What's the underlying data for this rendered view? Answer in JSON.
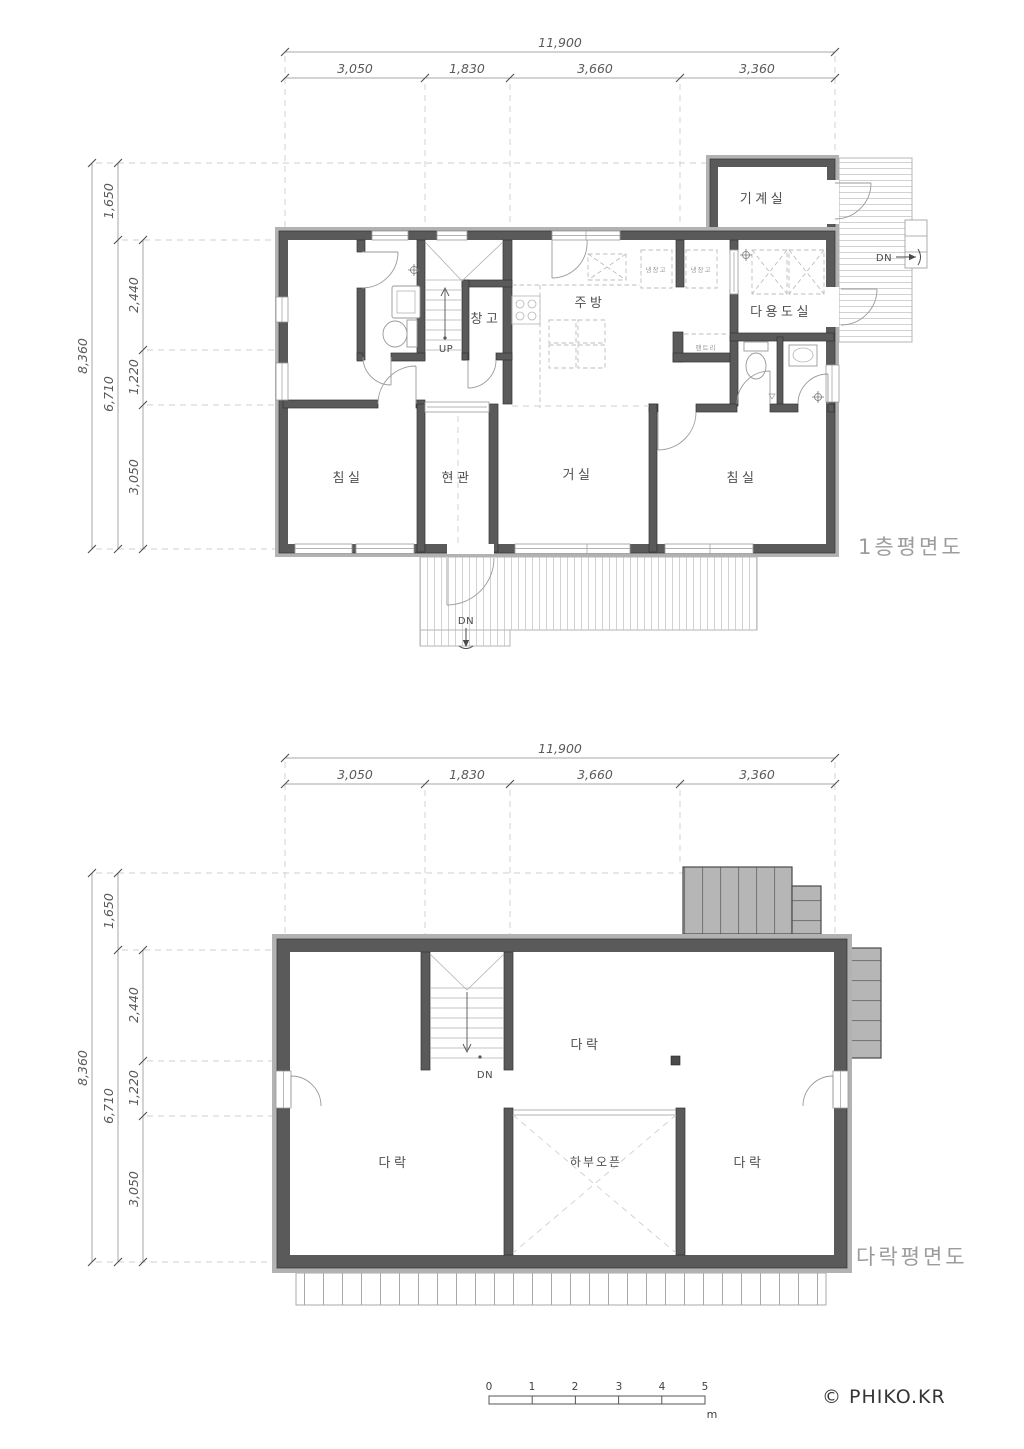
{
  "dimensions_top": {
    "total": "11,900",
    "segments": [
      "3,050",
      "1,830",
      "3,660",
      "3,360"
    ]
  },
  "dimensions_left": {
    "total": "8,360",
    "seg_upper": "1,650",
    "seg_mid": "6,710",
    "segments": [
      "2,440",
      "1,220",
      "3,050"
    ]
  },
  "first_floor": {
    "title": "1층평면도",
    "labels": {
      "machine_room": "기계실",
      "storage": "창고",
      "kitchen": "주방",
      "utility_room": "다용도실",
      "fridge_left": "냉장고",
      "fridge_right": "냉장고",
      "pantry": "팬트리",
      "bedroom_left": "침실",
      "entrance": "현관",
      "living_room": "거실",
      "bedroom_right": "침실",
      "stair_up": "UP",
      "porch_down": "DN",
      "deck_down": "DN"
    }
  },
  "attic": {
    "title": "다락평면도",
    "labels": {
      "attic_center": "다락",
      "attic_left": "다락",
      "attic_right": "다락",
      "open_below": "하부오픈",
      "stair_down": "DN"
    }
  },
  "scale_bar": {
    "ticks": [
      "0",
      "1",
      "2",
      "3",
      "4",
      "5"
    ],
    "unit": "m"
  },
  "credit": "© PHIKO.KR",
  "colors": {
    "wall": "#5a5a5a",
    "wall_band": "#b2b2b2",
    "roof_fill": "#b5b5b5",
    "dimension": "#5a5a5a",
    "title": "#9c9c9c"
  }
}
